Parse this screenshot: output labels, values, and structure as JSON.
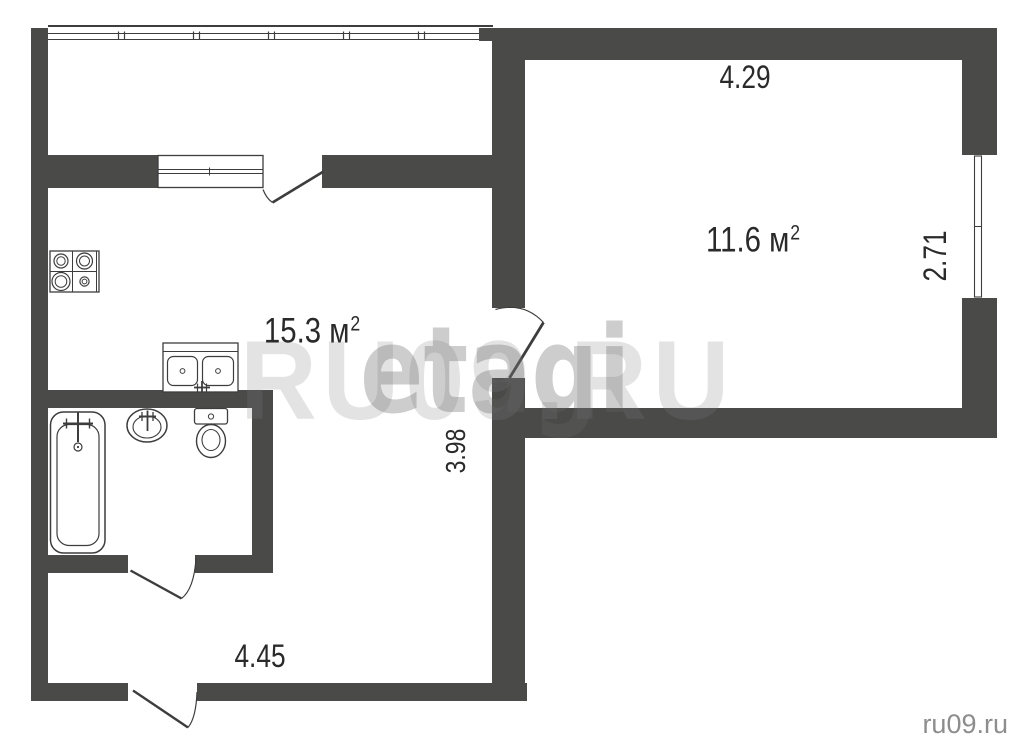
{
  "page": {
    "background": "#ffffff",
    "type": "apartment-floor-plan"
  },
  "colors": {
    "wall": "#4a4a49",
    "line": "#3d3d3d",
    "label_text": "#2a2a2a",
    "watermark_site": "#e9e9e9",
    "watermark_agency": "#d2d2d2",
    "corner_text": "#8d8d8d"
  },
  "rooms": [
    {
      "name": "kitchen-living-room",
      "area_label": "15.3 м",
      "area_sup": "2"
    },
    {
      "name": "room",
      "area_label": "11.6 м",
      "area_sup": "2"
    }
  ],
  "dimensions": {
    "room_width_top": "4.29",
    "room_depth_right": "2.71",
    "kitchen_depth_middle": "3.98",
    "hall_width_bottom": "4.45"
  },
  "watermarks": {
    "site_large": "RU09.RU",
    "agency": "еtagi",
    "site_corner": "ru09.ru"
  },
  "fixtures": [
    {
      "name": "stove-icon"
    },
    {
      "name": "kitchen-sink-icon"
    },
    {
      "name": "bathtub-icon"
    },
    {
      "name": "washbasin-icon"
    },
    {
      "name": "toilet-icon"
    }
  ],
  "features": [
    {
      "name": "balcony-glazing"
    },
    {
      "name": "kitchen-window"
    },
    {
      "name": "room-window"
    },
    {
      "name": "balcony-door"
    },
    {
      "name": "room-door"
    },
    {
      "name": "bathroom-door"
    },
    {
      "name": "entrance-door"
    }
  ]
}
